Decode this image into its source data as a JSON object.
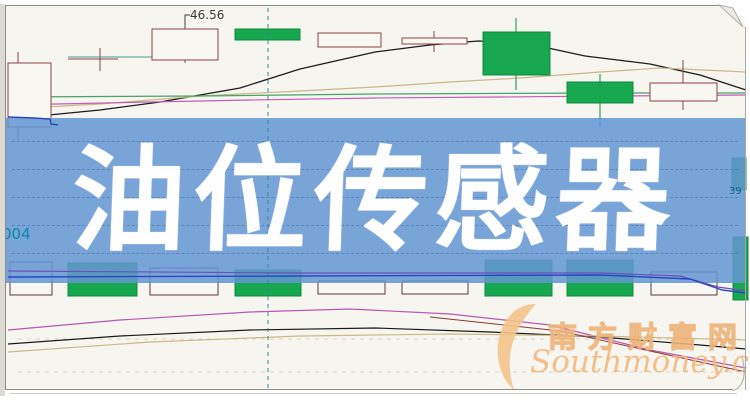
{
  "banner": {
    "title": "油位传感器"
  },
  "annotations": {
    "price_peak": "46.56",
    "left_code": "004",
    "right_price": "39"
  },
  "watermark": {
    "cn": "南方财富网",
    "en": "Southmoney.com"
  },
  "chart_data": {
    "type": "candlestick",
    "title": "油位传感器",
    "description": "Daily K-line stock chart with moving averages and a lower volume pane; no axis scales visible except one price annotation 46.56. A semi-transparent blue title banner covers the middle of the chart.",
    "style": {
      "background": "#f7f5ef",
      "candle_up_fill": "#f9f7f1",
      "candle_stroke": "#8b4242",
      "candle_down_fill": "#17a74f",
      "candle_down_stroke": "#0f8a40",
      "volume_white_stroke": "#5d3838",
      "banner_blue": "rgba(100,150,212,0.86)",
      "vline_teal": "#2a8aa0",
      "grid_dash": "#d9d2c4"
    },
    "candles": [
      {
        "x": 8,
        "w": 43,
        "top": 63,
        "bottom": 127,
        "type": "white",
        "wick": {
          "x": 18,
          "y1": 52,
          "y2": 140
        }
      },
      {
        "doji": true,
        "hx1": 68,
        "hx2": 118,
        "hy": 59,
        "vx": 100,
        "vy1": 48,
        "vy2": 71
      },
      {
        "x": 152,
        "w": 66,
        "top": 29,
        "bottom": 60,
        "type": "white",
        "wick": {
          "x": 185,
          "y1": 22,
          "y2": 63
        }
      },
      {
        "x": 235,
        "w": 65,
        "top": 29,
        "bottom": 40,
        "type": "green"
      },
      {
        "x": 318,
        "w": 63,
        "top": 33,
        "bottom": 47,
        "type": "white"
      },
      {
        "x": 402,
        "w": 65,
        "top": 38,
        "bottom": 44,
        "type": "white",
        "wick": {
          "x": 434,
          "y1": 31,
          "y2": 52
        }
      },
      {
        "x": 483,
        "w": 67,
        "top": 32,
        "bottom": 75,
        "type": "green",
        "wick": {
          "x": 516,
          "y1": 18,
          "y2": 90
        }
      },
      {
        "x": 567,
        "w": 66,
        "top": 82,
        "bottom": 103,
        "type": "green",
        "wick": {
          "x": 600,
          "y1": 74,
          "y2": 126
        }
      },
      {
        "x": 650,
        "w": 67,
        "top": 83,
        "bottom": 101,
        "type": "white",
        "wick": {
          "x": 683,
          "y1": 60,
          "y2": 110
        }
      },
      {
        "x": 732,
        "w": 14,
        "top": 158,
        "bottom": 190,
        "type": "green"
      }
    ],
    "volume_bars": [
      {
        "x": 10,
        "w": 42,
        "top": 262,
        "bottom": 295,
        "type": "white"
      },
      {
        "x": 68,
        "w": 69,
        "top": 263,
        "bottom": 296,
        "type": "green"
      },
      {
        "x": 150,
        "w": 68,
        "top": 268,
        "bottom": 295,
        "type": "white"
      },
      {
        "x": 235,
        "w": 66,
        "top": 270,
        "bottom": 296,
        "type": "green"
      },
      {
        "x": 318,
        "w": 67,
        "top": 281,
        "bottom": 294,
        "type": "white"
      },
      {
        "x": 402,
        "w": 66,
        "top": 281,
        "bottom": 294,
        "type": "white"
      },
      {
        "x": 485,
        "w": 67,
        "top": 260,
        "bottom": 296,
        "type": "green"
      },
      {
        "x": 567,
        "w": 66,
        "top": 260,
        "bottom": 296,
        "type": "green"
      },
      {
        "x": 651,
        "w": 66,
        "top": 272,
        "bottom": 295,
        "type": "white"
      },
      {
        "x": 733,
        "w": 15,
        "top": 237,
        "bottom": 300,
        "type": "green"
      }
    ],
    "lines": [
      {
        "name": "ma-black-upper",
        "color": "#1b1b1b",
        "width": 1.2,
        "points": [
          [
            8,
            119
          ],
          [
            100,
            110
          ],
          [
            160,
            102
          ],
          [
            240,
            88
          ],
          [
            300,
            69
          ],
          [
            375,
            52
          ],
          [
            430,
            45
          ],
          [
            478,
            41
          ],
          [
            525,
            43
          ],
          [
            585,
            56
          ],
          [
            650,
            64
          ],
          [
            700,
            75
          ],
          [
            746,
            90
          ]
        ]
      },
      {
        "name": "ma-tan-upper",
        "color": "#c9b98a",
        "width": 1.2,
        "points": [
          [
            8,
            109
          ],
          [
            100,
            104
          ],
          [
            200,
            96
          ],
          [
            300,
            91
          ],
          [
            375,
            87
          ],
          [
            450,
            82
          ],
          [
            520,
            78
          ],
          [
            600,
            72
          ],
          [
            660,
            68
          ],
          [
            746,
            72
          ]
        ]
      },
      {
        "name": "ma-green-upper",
        "color": "#4aa06a",
        "width": 1.2,
        "points": [
          [
            8,
            97
          ],
          [
            200,
            96
          ],
          [
            375,
            94
          ],
          [
            600,
            93
          ],
          [
            746,
            93
          ]
        ]
      },
      {
        "name": "ma-magenta-upper",
        "color": "#c05fb8",
        "width": 1.2,
        "points": [
          [
            8,
            105
          ],
          [
            150,
            102
          ],
          [
            250,
            100
          ],
          [
            375,
            98
          ],
          [
            500,
            97
          ],
          [
            620,
            96
          ],
          [
            746,
            95
          ]
        ]
      },
      {
        "name": "level-teal",
        "color": "#4a9a94",
        "width": 1,
        "points": [
          [
            68,
            57
          ],
          [
            152,
            57
          ]
        ]
      },
      {
        "name": "ma-magenta-lower",
        "color": "#b558ae",
        "width": 1.2,
        "points": [
          [
            8,
            330
          ],
          [
            120,
            320
          ],
          [
            250,
            312
          ],
          [
            350,
            309
          ],
          [
            450,
            314
          ],
          [
            550,
            325
          ],
          [
            650,
            350
          ],
          [
            746,
            368
          ]
        ]
      },
      {
        "name": "ma-black-lower",
        "color": "#1b1b1b",
        "width": 1.2,
        "points": [
          [
            8,
            344
          ],
          [
            120,
            336
          ],
          [
            250,
            330
          ],
          [
            375,
            328
          ],
          [
            490,
            332
          ],
          [
            600,
            337
          ],
          [
            700,
            345
          ],
          [
            746,
            349
          ]
        ]
      },
      {
        "name": "ma-tan-lower",
        "color": "#c9b98a",
        "width": 1.2,
        "points": [
          [
            8,
            352
          ],
          [
            150,
            342
          ],
          [
            300,
            336
          ],
          [
            450,
            334
          ],
          [
            600,
            336
          ],
          [
            746,
            340
          ]
        ]
      },
      {
        "name": "ma-darkred-lower",
        "color": "#8b3535",
        "width": 1,
        "points": [
          [
            430,
            317
          ],
          [
            560,
            331
          ],
          [
            650,
            351
          ],
          [
            746,
            372
          ]
        ]
      }
    ],
    "overlines": [
      {
        "name": "ma-purple-mid",
        "color": "#6a52b8",
        "width": 1.2,
        "points": [
          [
            8,
            271
          ],
          [
            300,
            273
          ],
          [
            600,
            273
          ],
          [
            680,
            276
          ],
          [
            718,
            287
          ],
          [
            746,
            291
          ]
        ]
      },
      {
        "name": "ma-blue-mid",
        "color": "#2b46c0",
        "width": 1.4,
        "points": [
          [
            8,
            277
          ],
          [
            300,
            276
          ],
          [
            600,
            275
          ],
          [
            690,
            279
          ],
          [
            722,
            290
          ],
          [
            746,
            293
          ]
        ]
      },
      {
        "name": "ma-blue-step",
        "color": "#2b46c0",
        "width": 1.4,
        "points": [
          [
            8,
            117
          ],
          [
            34,
            118
          ],
          [
            50,
            119
          ],
          [
            51,
            124
          ],
          [
            58,
            125
          ]
        ]
      }
    ],
    "vline": {
      "x": 268,
      "y1": 8,
      "y2": 388,
      "color": "#2a8aa0",
      "dash": "4,4"
    },
    "lower_gridlines_y": [
      339,
      372
    ],
    "banner_gridline_offsets": [
      23,
      51,
      79,
      107,
      135
    ],
    "annotation_connector": [
      [
        185,
        28
      ],
      [
        185,
        15
      ],
      [
        190,
        15
      ]
    ]
  }
}
